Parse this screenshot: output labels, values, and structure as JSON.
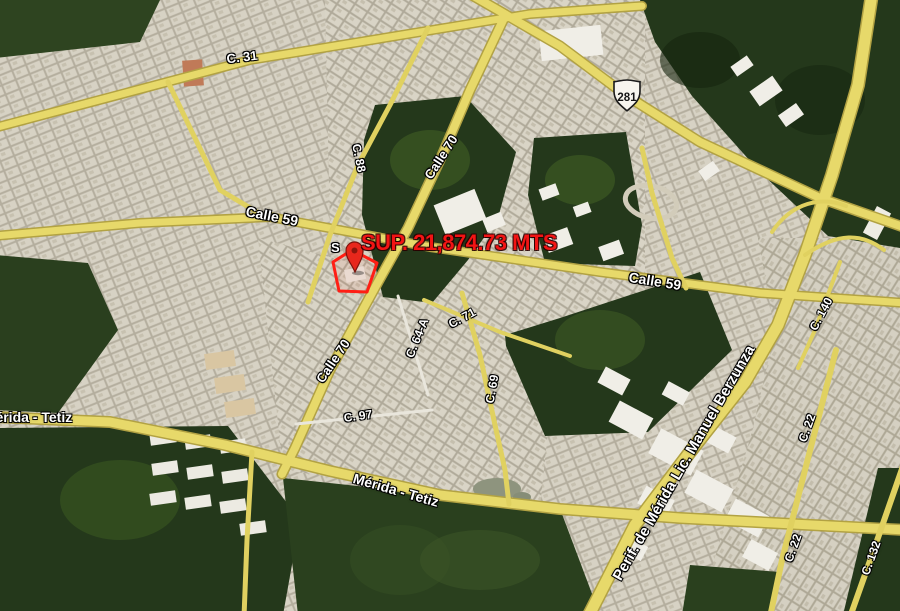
{
  "map": {
    "annotation": {
      "text": "SUP. 21,874.73 MTS",
      "marker_letter": "S",
      "text_color": "#f21414"
    },
    "highway_shield": {
      "number": "281"
    },
    "street_labels": [
      {
        "id": "c-31",
        "text": "C. 31",
        "x": 242,
        "y": 57,
        "rot": -7,
        "size": 13
      },
      {
        "id": "calle-59-west",
        "text": "Calle 59",
        "x": 272,
        "y": 216,
        "rot": 11,
        "size": 14
      },
      {
        "id": "c-88",
        "text": "C. 88",
        "x": 359,
        "y": 158,
        "rot": 78,
        "size": 12
      },
      {
        "id": "calle-70-north",
        "text": "Calle 70",
        "x": 441,
        "y": 157,
        "rot": -57,
        "size": 13
      },
      {
        "id": "calle-59-east",
        "text": "Calle 59",
        "x": 655,
        "y": 281,
        "rot": 9,
        "size": 14
      },
      {
        "id": "c-140",
        "text": "C. 140",
        "x": 821,
        "y": 314,
        "rot": -62,
        "size": 12
      },
      {
        "id": "c-71",
        "text": "C. 71",
        "x": 462,
        "y": 318,
        "rot": -28,
        "size": 12
      },
      {
        "id": "c-64-a",
        "text": "C. 64-A",
        "x": 417,
        "y": 338,
        "rot": -68,
        "size": 12
      },
      {
        "id": "calle-70-south",
        "text": "Calle 70",
        "x": 333,
        "y": 361,
        "rot": -56,
        "size": 13
      },
      {
        "id": "c-97",
        "text": "C. 97",
        "x": 358,
        "y": 416,
        "rot": -8,
        "size": 12
      },
      {
        "id": "c-69",
        "text": "C. 69",
        "x": 492,
        "y": 389,
        "rot": -80,
        "size": 12
      },
      {
        "id": "merida-tetiz-west",
        "text": "Mérida - Tetiz",
        "x": 28,
        "y": 417,
        "rot": 0,
        "size": 14
      },
      {
        "id": "merida-tetiz-center",
        "text": "Mérida - Tetiz",
        "x": 396,
        "y": 490,
        "rot": 16,
        "size": 14
      },
      {
        "id": "periferico",
        "text": "Perif. de Mérida Lic. Manuel Berzunza",
        "x": 684,
        "y": 463,
        "rot": -60,
        "size": 15
      },
      {
        "id": "c-22-north",
        "text": "C. 22",
        "x": 807,
        "y": 428,
        "rot": -70,
        "size": 12
      },
      {
        "id": "c-22-south",
        "text": "C. 22",
        "x": 793,
        "y": 548,
        "rot": -70,
        "size": 12
      },
      {
        "id": "c-132",
        "text": "C. 132",
        "x": 871,
        "y": 558,
        "rot": -70,
        "size": 12
      }
    ],
    "colors": {
      "road_fill": "#e7d96a",
      "road_casing": "#b2a243",
      "vegetation": "#24381b",
      "urban_light": "#d7d2c4",
      "urban_dark": "#b4ae9e",
      "parcel_outline": "#ff1e14",
      "label_text": "#ffffff"
    }
  }
}
